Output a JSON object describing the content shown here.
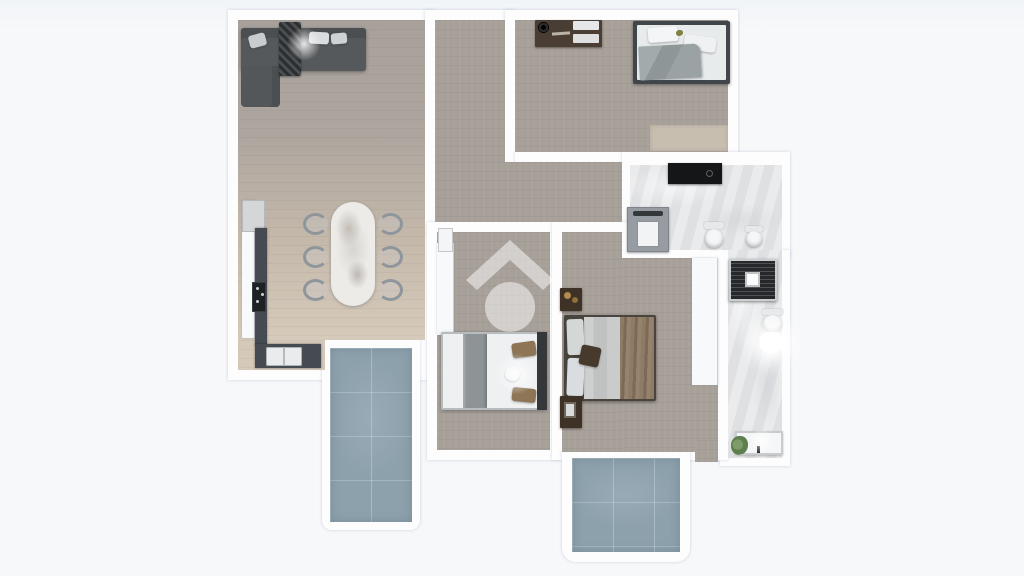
{
  "scene": {
    "kind": "rendered-3d-floor-plan-top-down",
    "background_color": "#f6f8fa",
    "wall_color": "#fdfdfe",
    "text": "none-visible"
  },
  "palette": {
    "wood_floor_gray": "#a7a099",
    "wood_floor_beige": "#d5c9ba",
    "marble_floor": "#e3e4e6",
    "terrace_tile_blue": "#8da1ad",
    "sofa_gray": "#55595b",
    "counter_slate": "#454b50",
    "furniture_dark_brown": "#4a3e34",
    "bed_linen_white": "#eef0f1",
    "blanket_gray": "#9aa1a3",
    "throw_brown": "#8e7b66",
    "shower_black": "#26282b",
    "vanity_black": "#141618",
    "plant_green": "#6f8f5f",
    "watermark_white": "#ffffff"
  },
  "watermark": {
    "shape": "house-roof-chevron-above-circle",
    "color": "#ffffff",
    "opacity": 0.5,
    "location": "middle-left-bedroom-floor"
  },
  "rooms": [
    {
      "id": "living-kitchen-dining",
      "position": "top-left",
      "furniture": [
        "corner-sofa",
        "striped-throw-blanket",
        "sofa-pillows",
        "fridge-column",
        "kitchen-counter-run",
        "cooktop",
        "kitchen-sink",
        "marble-dining-table",
        "six-dining-chairs"
      ]
    },
    {
      "id": "hallway",
      "position": "center-top",
      "furniture": []
    },
    {
      "id": "bedroom-top-right",
      "furniture": [
        "dresser-with-decor",
        "double-bed-gray-blanket",
        "light-rug"
      ]
    },
    {
      "id": "bathroom-main",
      "position": "right-upper",
      "furniture": [
        "black-vanity-counter",
        "washing-machine",
        "toilet",
        "bidet"
      ]
    },
    {
      "id": "bathroom-ensuite",
      "position": "right-strip",
      "furniture": [
        "black-tiled-shower",
        "toilet",
        "wall-sink-lit",
        "bathtub",
        "potted-plant"
      ]
    },
    {
      "id": "bedroom-middle-left",
      "furniture": [
        "white-wardrobe-strip",
        "door-leaf",
        "double-bed-white-runner",
        "watermark-logo"
      ]
    },
    {
      "id": "bedroom-middle-right",
      "furniture": [
        "nightstand-top",
        "double-bed-brown-throw",
        "nightstand-bottom",
        "white-wardrobe"
      ]
    },
    {
      "id": "terrace-left",
      "floor": "blue-tile"
    },
    {
      "id": "terrace-bottom",
      "floor": "blue-tile"
    }
  ]
}
